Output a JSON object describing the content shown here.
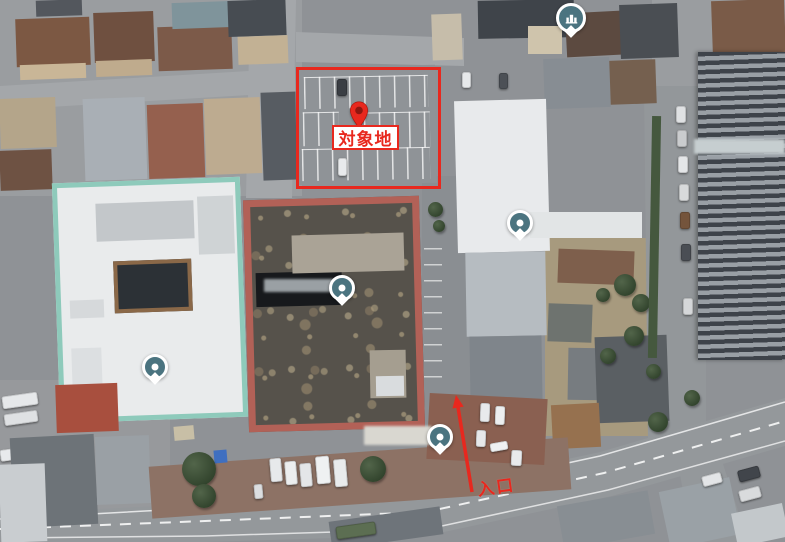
{
  "map": {
    "title": "aerial-site-map"
  },
  "annotations": {
    "accent_color": "#e8281e",
    "target": {
      "label": "対象地",
      "rect": {
        "x": 296,
        "y": 67,
        "w": 139,
        "h": 116
      },
      "label_box": {
        "x": 332,
        "y": 125,
        "w": 67,
        "h": 25
      },
      "pin": {
        "x": 359,
        "y": 110
      }
    },
    "entrance": {
      "label": "入口",
      "arrow": {
        "x1": 472,
        "y1": 492,
        "x2": 456,
        "y2": 395
      },
      "text": {
        "x": 477,
        "y": 473
      }
    }
  },
  "markers": {
    "color": "#4b7480",
    "poi_dots": [
      {
        "x": 342,
        "y": 288
      },
      {
        "x": 520,
        "y": 223
      },
      {
        "x": 155,
        "y": 367
      },
      {
        "x": 440,
        "y": 437
      }
    ],
    "lodging": {
      "x": 570,
      "y": 17
    }
  },
  "blurs": [
    {
      "x": 364,
      "y": 426,
      "w": 68,
      "h": 19,
      "c": "#d9d7d0"
    },
    {
      "x": 264,
      "y": 279,
      "w": 70,
      "h": 13,
      "c": "#9aa0a4"
    },
    {
      "x": 694,
      "y": 139,
      "w": 91,
      "h": 15,
      "c": "#c6ced0"
    }
  ],
  "scene": [
    {
      "n": "house-roof",
      "x": 16,
      "y": 18,
      "w": 74,
      "h": 48,
      "c": "#7c5843",
      "cls": "hip",
      "r": -2
    },
    {
      "n": "house-facade",
      "x": 20,
      "y": 64,
      "w": 66,
      "h": 15,
      "c": "#c9b697",
      "r": -2
    },
    {
      "n": "house-roof",
      "x": 94,
      "y": 12,
      "w": 60,
      "h": 50,
      "c": "#6f5040",
      "cls": "hip",
      "r": -2
    },
    {
      "n": "house-facade",
      "x": 96,
      "y": 60,
      "w": 56,
      "h": 16,
      "c": "#bfab8d",
      "r": -2
    },
    {
      "n": "house-roof",
      "x": 158,
      "y": 26,
      "w": 74,
      "h": 44,
      "c": "#7c5a49",
      "cls": "hip",
      "r": -2
    },
    {
      "n": "greenhouse-roof",
      "x": 172,
      "y": 2,
      "w": 62,
      "h": 26,
      "c": "#7f949b",
      "cls": "glass",
      "r": -2
    },
    {
      "n": "house-roof",
      "x": 228,
      "y": 0,
      "w": 58,
      "h": 36,
      "c": "#474c52",
      "r": -2
    },
    {
      "n": "house-facade",
      "x": 238,
      "y": 36,
      "w": 50,
      "h": 28,
      "c": "#c2b194",
      "r": -2
    },
    {
      "n": "house-roof",
      "x": 36,
      "y": 0,
      "w": 46,
      "h": 16,
      "c": "#53575d",
      "r": -2
    },
    {
      "n": "house-roof",
      "x": 84,
      "y": 98,
      "w": 62,
      "h": 82,
      "c": "#a9afb5",
      "cls": "hip",
      "r": -2
    },
    {
      "n": "house-roof",
      "x": 148,
      "y": 104,
      "w": 56,
      "h": 74,
      "c": "#95604e",
      "cls": "hip",
      "r": -2
    },
    {
      "n": "house-roof",
      "x": 205,
      "y": 98,
      "w": 56,
      "h": 76,
      "c": "#bdab90",
      "cls": "hip",
      "r": -2
    },
    {
      "n": "house-roof",
      "x": 262,
      "y": 92,
      "w": 40,
      "h": 88,
      "c": "#575c62",
      "r": -2
    },
    {
      "n": "house-roof",
      "x": 0,
      "y": 98,
      "w": 56,
      "h": 50,
      "c": "#b4a58a",
      "r": -2
    },
    {
      "n": "house-roof",
      "x": 0,
      "y": 150,
      "w": 52,
      "h": 40,
      "c": "#6e5243",
      "cls": "hip",
      "r": -2
    },
    {
      "n": "parking-lot",
      "x": 296,
      "y": 66,
      "w": 140,
      "h": 118,
      "c": "#8f9397",
      "r": -1
    },
    {
      "n": "parking-stalls",
      "x": 304,
      "y": 76,
      "w": 124,
      "h": 32,
      "cls": "stalls",
      "r": -1
    },
    {
      "n": "parking-stalls",
      "x": 303,
      "y": 112,
      "w": 36,
      "h": 34,
      "cls": "stalls",
      "r": -1
    },
    {
      "n": "parking-stalls",
      "x": 364,
      "y": 112,
      "w": 66,
      "h": 36,
      "cls": "stalls",
      "r": -1
    },
    {
      "n": "parking-stalls",
      "x": 302,
      "y": 148,
      "w": 128,
      "h": 32,
      "cls": "stalls",
      "r": -1
    },
    {
      "n": "car",
      "x": 337,
      "y": 79,
      "w": 10,
      "h": 17,
      "c": "#3a3e44",
      "cls": "car"
    },
    {
      "n": "car",
      "x": 338,
      "y": 158,
      "w": 9,
      "h": 18,
      "c": "#e8eaec",
      "cls": "car"
    },
    {
      "n": "building-roof",
      "x": 432,
      "y": 14,
      "w": 30,
      "h": 46,
      "c": "#c6bdaa",
      "r": -2
    },
    {
      "n": "building-roof",
      "x": 478,
      "y": 0,
      "w": 96,
      "h": 38,
      "c": "#3f444a",
      "r": -1
    },
    {
      "n": "building-facade",
      "x": 528,
      "y": 26,
      "w": 34,
      "h": 28,
      "c": "#cfc4ac"
    },
    {
      "n": "house-roof",
      "x": 566,
      "y": 12,
      "w": 56,
      "h": 44,
      "c": "#5c4a40",
      "cls": "tile",
      "r": -3
    },
    {
      "n": "house-roof",
      "x": 620,
      "y": 4,
      "w": 58,
      "h": 54,
      "c": "#4a4e53",
      "r": -2
    },
    {
      "n": "house-roof",
      "x": 544,
      "y": 58,
      "w": 66,
      "h": 50,
      "c": "#878d93",
      "cls": "hip",
      "r": -2
    },
    {
      "n": "car",
      "x": 462,
      "y": 72,
      "w": 9,
      "h": 16,
      "c": "#e6e8ea",
      "cls": "car"
    },
    {
      "n": "car",
      "x": 499,
      "y": 73,
      "w": 9,
      "h": 16,
      "c": "#4c5056",
      "cls": "car"
    },
    {
      "n": "house-roof",
      "x": 610,
      "y": 60,
      "w": 46,
      "h": 44,
      "c": "#75604f",
      "r": -2
    },
    {
      "n": "house-roof",
      "x": 712,
      "y": 0,
      "w": 73,
      "h": 56,
      "c": "#7a5b48",
      "cls": "hip",
      "r": -2
    },
    {
      "n": "dirt-patch",
      "x": 738,
      "y": 54,
      "w": 47,
      "h": 52,
      "c": "#b09a78"
    },
    {
      "n": "building-roof",
      "x": 748,
      "y": 94,
      "w": 37,
      "h": 36,
      "c": "#6b6f74"
    },
    {
      "n": "building-mint",
      "x": 56,
      "y": 180,
      "w": 188,
      "h": 240,
      "c": "#e9ebec",
      "r": -2,
      "b": "5px solid #8ecabb"
    },
    {
      "n": "rooftop-units",
      "x": 96,
      "y": 202,
      "w": 98,
      "h": 38,
      "c": "#c3c7ca",
      "cls": "vents",
      "r": -2
    },
    {
      "n": "rooftop-units",
      "x": 198,
      "y": 196,
      "w": 36,
      "h": 58,
      "c": "#cfd3d5",
      "r": -2
    },
    {
      "n": "courtyard",
      "x": 114,
      "y": 260,
      "w": 78,
      "h": 52,
      "c": "#2c3136",
      "r": -2,
      "b": "4px solid #8a6848"
    },
    {
      "n": "rooftop-unit",
      "x": 70,
      "y": 300,
      "w": 34,
      "h": 18,
      "c": "#d6d9db",
      "r": -2
    },
    {
      "n": "rooftop-unit",
      "x": 72,
      "y": 348,
      "w": 30,
      "h": 44,
      "c": "#dcdfe1",
      "r": -2
    },
    {
      "n": "building-salmon",
      "x": 246,
      "y": 198,
      "w": 176,
      "h": 232,
      "r": -1.5,
      "b": "7px solid #b26157",
      "cls": "tex-roof"
    },
    {
      "n": "roof-slot",
      "x": 256,
      "y": 272,
      "w": 86,
      "h": 34,
      "c": "#17191c",
      "r": -1.5
    },
    {
      "n": "rooftop-units",
      "x": 292,
      "y": 234,
      "w": 112,
      "h": 38,
      "c": "#aaa396",
      "cls": "vents",
      "r": -1.5
    },
    {
      "n": "rooftop-unit",
      "x": 370,
      "y": 350,
      "w": 36,
      "h": 48,
      "c": "#a59e90",
      "r": -1
    },
    {
      "n": "rooftop-unit",
      "x": 376,
      "y": 376,
      "w": 28,
      "h": 20,
      "c": "#d9dcde",
      "r": -1
    },
    {
      "n": "building-white",
      "x": 456,
      "y": 100,
      "w": 92,
      "h": 152,
      "c": "#e8eaec",
      "r": -1.5
    },
    {
      "n": "building-annex",
      "x": 466,
      "y": 252,
      "w": 80,
      "h": 84,
      "c": "#b6bcc1",
      "r": -1
    },
    {
      "n": "building-annex",
      "x": 470,
      "y": 336,
      "w": 72,
      "h": 66,
      "c": "#7f858b",
      "r": -1
    },
    {
      "n": "roof-band",
      "x": 530,
      "y": 212,
      "w": 112,
      "h": 26,
      "c": "#e2e5e6"
    },
    {
      "n": "parking-stalls",
      "x": 424,
      "y": 248,
      "w": 18,
      "h": 132,
      "cls": "stalls-v"
    },
    {
      "n": "tree",
      "x": 428,
      "y": 202,
      "w": 15,
      "h": 15,
      "cls": "tree"
    },
    {
      "n": "tree",
      "x": 433,
      "y": 220,
      "w": 12,
      "h": 12,
      "cls": "tree"
    },
    {
      "n": "building-roof",
      "x": 558,
      "y": 250,
      "w": 76,
      "h": 34,
      "c": "#7e5f4c",
      "r": 2
    },
    {
      "n": "building-roof",
      "x": 548,
      "y": 304,
      "w": 44,
      "h": 38,
      "c": "#6e736f",
      "r": 2
    },
    {
      "n": "building-roof",
      "x": 568,
      "y": 348,
      "w": 34,
      "h": 52,
      "c": "#777c80",
      "r": 1
    },
    {
      "n": "building-roof",
      "x": 596,
      "y": 336,
      "w": 72,
      "h": 86,
      "c": "#5a5f63",
      "r": -2
    },
    {
      "n": "building-roof",
      "x": 552,
      "y": 404,
      "w": 48,
      "h": 44,
      "c": "#96714f",
      "cls": "tile",
      "r": -3
    },
    {
      "n": "tree",
      "x": 614,
      "y": 274,
      "w": 22,
      "h": 22,
      "cls": "tree"
    },
    {
      "n": "tree",
      "x": 632,
      "y": 294,
      "w": 18,
      "h": 18,
      "cls": "tree"
    },
    {
      "n": "tree",
      "x": 596,
      "y": 288,
      "w": 14,
      "h": 14,
      "cls": "tree"
    },
    {
      "n": "tree",
      "x": 624,
      "y": 326,
      "w": 20,
      "h": 20,
      "cls": "tree"
    },
    {
      "n": "tree",
      "x": 600,
      "y": 348,
      "w": 16,
      "h": 16,
      "cls": "tree"
    },
    {
      "n": "tree",
      "x": 646,
      "y": 364,
      "w": 15,
      "h": 15,
      "cls": "tree"
    },
    {
      "n": "tree",
      "x": 684,
      "y": 390,
      "w": 16,
      "h": 16,
      "cls": "tree"
    },
    {
      "n": "hedge",
      "x": 650,
      "y": 116,
      "w": 9,
      "h": 242,
      "c": "#45583e",
      "r": 1
    },
    {
      "n": "car",
      "x": 676,
      "y": 106,
      "w": 10,
      "h": 17,
      "c": "#dfe1e3",
      "cls": "car"
    },
    {
      "n": "car",
      "x": 677,
      "y": 130,
      "w": 10,
      "h": 17,
      "c": "#caccce",
      "cls": "car"
    },
    {
      "n": "car",
      "x": 678,
      "y": 156,
      "w": 10,
      "h": 17,
      "c": "#e4e6e8",
      "cls": "car"
    },
    {
      "n": "car",
      "x": 679,
      "y": 184,
      "w": 10,
      "h": 17,
      "c": "#d8dadb",
      "cls": "car"
    },
    {
      "n": "car",
      "x": 680,
      "y": 212,
      "w": 10,
      "h": 17,
      "c": "#74543c",
      "cls": "car"
    },
    {
      "n": "car",
      "x": 681,
      "y": 244,
      "w": 10,
      "h": 17,
      "c": "#4a4e54",
      "cls": "car"
    },
    {
      "n": "car",
      "x": 683,
      "y": 298,
      "w": 10,
      "h": 17,
      "c": "#d5d7d9",
      "cls": "car"
    },
    {
      "n": "building-tower",
      "x": 698,
      "y": 52,
      "w": 87,
      "h": 308,
      "cls": "tower"
    },
    {
      "n": "car",
      "x": 2,
      "y": 394,
      "w": 36,
      "h": 13,
      "c": "#e6e8ea",
      "cls": "car",
      "r": -8
    },
    {
      "n": "car",
      "x": 4,
      "y": 412,
      "w": 34,
      "h": 12,
      "c": "#dfe1e3",
      "cls": "car",
      "r": -8
    },
    {
      "n": "car",
      "x": 0,
      "y": 448,
      "w": 30,
      "h": 12,
      "c": "#e8eaec",
      "cls": "car",
      "r": -8
    },
    {
      "n": "house-roof",
      "x": 56,
      "y": 384,
      "w": 62,
      "h": 48,
      "c": "#a84f3e",
      "cls": "tile",
      "r": -2
    },
    {
      "n": "house-roof",
      "x": 12,
      "y": 436,
      "w": 84,
      "h": 90,
      "c": "#6d7378",
      "cls": "hip",
      "r": -3
    },
    {
      "n": "building-roof",
      "x": 0,
      "y": 464,
      "w": 46,
      "h": 78,
      "c": "#c9cdd0",
      "r": -2
    },
    {
      "n": "building-roof",
      "x": 96,
      "y": 436,
      "w": 54,
      "h": 68,
      "c": "#9aa0a5",
      "r": -2
    },
    {
      "n": "pavement-brown",
      "x": 150,
      "y": 452,
      "w": 420,
      "h": 52,
      "c": "#8d7265",
      "r": -4
    },
    {
      "n": "courtyard-brown",
      "x": 428,
      "y": 396,
      "w": 118,
      "h": 66,
      "c": "#8a6051",
      "r": 3
    },
    {
      "n": "shed",
      "x": 174,
      "y": 426,
      "w": 20,
      "h": 14,
      "c": "#c8bfa6",
      "r": -5
    },
    {
      "n": "blue-tarp",
      "x": 214,
      "y": 450,
      "w": 13,
      "h": 13,
      "c": "#3f6fc0",
      "r": -5
    },
    {
      "n": "tree",
      "x": 182,
      "y": 452,
      "w": 34,
      "h": 34,
      "cls": "tree"
    },
    {
      "n": "tree",
      "x": 192,
      "y": 484,
      "w": 24,
      "h": 24,
      "cls": "tree"
    },
    {
      "n": "tree",
      "x": 360,
      "y": 456,
      "w": 26,
      "h": 26,
      "cls": "tree"
    },
    {
      "n": "tree",
      "x": 648,
      "y": 412,
      "w": 20,
      "h": 20,
      "cls": "tree"
    },
    {
      "n": "van",
      "x": 270,
      "y": 458,
      "w": 12,
      "h": 24,
      "c": "#e7e9eb",
      "cls": "car",
      "r": -5
    },
    {
      "n": "van",
      "x": 285,
      "y": 461,
      "w": 12,
      "h": 24,
      "c": "#eceeef",
      "cls": "car",
      "r": -5
    },
    {
      "n": "van",
      "x": 300,
      "y": 463,
      "w": 12,
      "h": 24,
      "c": "#e4e6e8",
      "cls": "car",
      "r": -5
    },
    {
      "n": "van",
      "x": 316,
      "y": 456,
      "w": 14,
      "h": 28,
      "c": "#eff1f2",
      "cls": "car",
      "r": -5
    },
    {
      "n": "van",
      "x": 334,
      "y": 459,
      "w": 13,
      "h": 28,
      "c": "#e9ebec",
      "cls": "car",
      "r": -5
    },
    {
      "n": "car",
      "x": 254,
      "y": 484,
      "w": 9,
      "h": 15,
      "c": "#dcdee0",
      "cls": "car",
      "r": -5
    },
    {
      "n": "van",
      "x": 480,
      "y": 403,
      "w": 10,
      "h": 19,
      "c": "#e8eaec",
      "cls": "car",
      "r": 2
    },
    {
      "n": "van",
      "x": 495,
      "y": 406,
      "w": 10,
      "h": 19,
      "c": "#eceeef",
      "cls": "car",
      "r": 2
    },
    {
      "n": "van",
      "x": 476,
      "y": 430,
      "w": 10,
      "h": 17,
      "c": "#e6e8ea",
      "cls": "car",
      "r": 2
    },
    {
      "n": "van",
      "x": 490,
      "y": 442,
      "w": 18,
      "h": 9,
      "c": "#eff1f2",
      "cls": "car",
      "r": -10
    },
    {
      "n": "van",
      "x": 511,
      "y": 450,
      "w": 11,
      "h": 16,
      "c": "#e8eaec",
      "cls": "car",
      "r": 3
    },
    {
      "n": "building-roof",
      "x": 330,
      "y": 514,
      "w": 112,
      "h": 28,
      "c": "#6e747a",
      "r": -8
    },
    {
      "n": "truck",
      "x": 336,
      "y": 524,
      "w": 40,
      "h": 13,
      "c": "#5c6e52",
      "cls": "car",
      "r": -8
    },
    {
      "n": "building-roof",
      "x": 560,
      "y": 498,
      "w": 92,
      "h": 44,
      "c": "#888e93",
      "r": -10
    },
    {
      "n": "building-roof",
      "x": 664,
      "y": 484,
      "w": 72,
      "h": 58,
      "c": "#9aa1a6",
      "r": -12
    },
    {
      "n": "building-roof",
      "x": 734,
      "y": 508,
      "w": 52,
      "h": 34,
      "c": "#c3c8cb",
      "r": -12
    },
    {
      "n": "car",
      "x": 738,
      "y": 468,
      "w": 22,
      "h": 12,
      "c": "#41454b",
      "cls": "car",
      "r": -15
    },
    {
      "n": "car",
      "x": 739,
      "y": 488,
      "w": 22,
      "h": 12,
      "c": "#d9dbdd",
      "cls": "car",
      "r": -15
    },
    {
      "n": "car",
      "x": 702,
      "y": 474,
      "w": 20,
      "h": 11,
      "c": "#e3e5e7",
      "cls": "car",
      "r": -15
    }
  ]
}
